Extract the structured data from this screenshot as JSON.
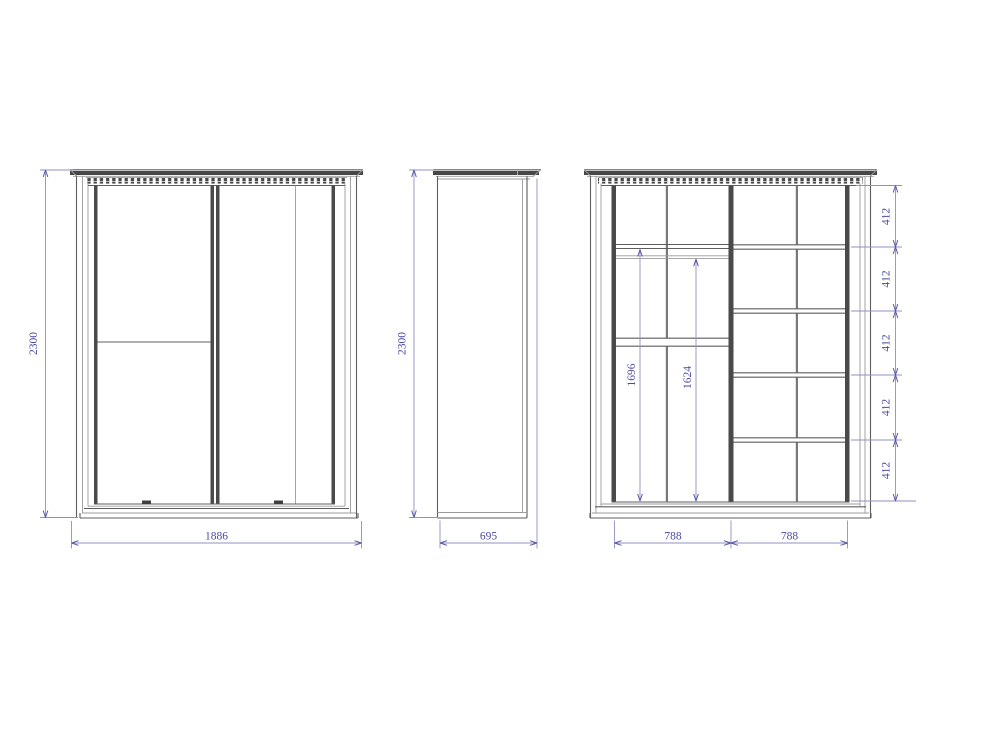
{
  "drawing": {
    "views": {
      "front": {
        "height_mm": "2300",
        "width_mm": "1886"
      },
      "side": {
        "height_mm": "2300",
        "depth_mm": "695"
      },
      "interior": {
        "hang_heights": {
          "left": "1696",
          "right": "1624"
        },
        "shelf_gaps_mm": [
          "412",
          "412",
          "412",
          "412",
          "412"
        ],
        "section_widths_mm": [
          "788",
          "788"
        ]
      }
    },
    "colors": {
      "background": "#ffffff",
      "line_heavy": "#474747",
      "line_medium": "#5e5e5e",
      "line_light": "#9b9b9b",
      "dimension_line": "#9090c2",
      "dimension_text": "#4a4a9e"
    }
  }
}
